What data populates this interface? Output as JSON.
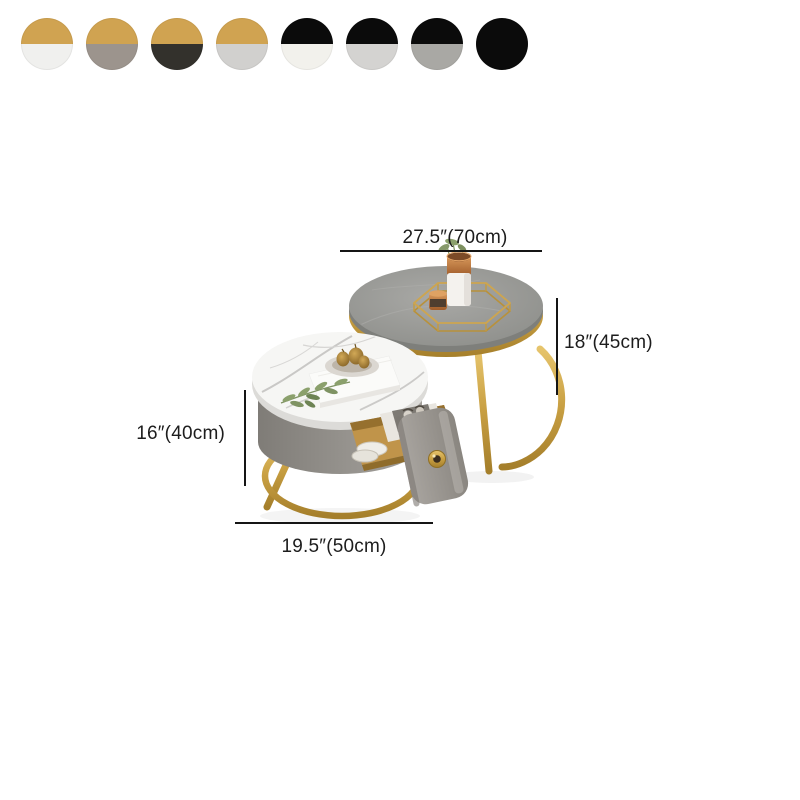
{
  "page": {
    "background": "#ffffff"
  },
  "swatches": {
    "items": [
      {
        "name": "gold-white",
        "top": "#D0A351",
        "bottom": "#F0F0EE"
      },
      {
        "name": "gold-gray",
        "top": "#D0A351",
        "bottom": "#9C948D"
      },
      {
        "name": "gold-charcoal",
        "top": "#D0A351",
        "bottom": "#33312C"
      },
      {
        "name": "gold-light-gray",
        "top": "#D0A351",
        "bottom": "#D1D0CE"
      },
      {
        "name": "black-white",
        "top": "#0B0B0B",
        "bottom": "#F2F1EC"
      },
      {
        "name": "black-light-gray",
        "top": "#0B0B0B",
        "bottom": "#D4D3D1"
      },
      {
        "name": "black-gray",
        "top": "#0B0B0B",
        "bottom": "#A9A8A4"
      },
      {
        "name": "black-black",
        "top": "#0B0B0B",
        "bottom": "#0B0B0B"
      }
    ]
  },
  "product": {
    "dimensions": {
      "large_diameter": "27.5″(70cm)",
      "large_height": "18″(45cm)",
      "small_height": "16″(40cm)",
      "small_diameter": "19.5″(50cm)"
    },
    "colors": {
      "gold_accent": "#C49B41",
      "large_table_top": "#9A9A97",
      "small_table_top_marble": "#F5F5F3",
      "small_table_body": "#918E89",
      "dimension_line": "#151515"
    }
  }
}
